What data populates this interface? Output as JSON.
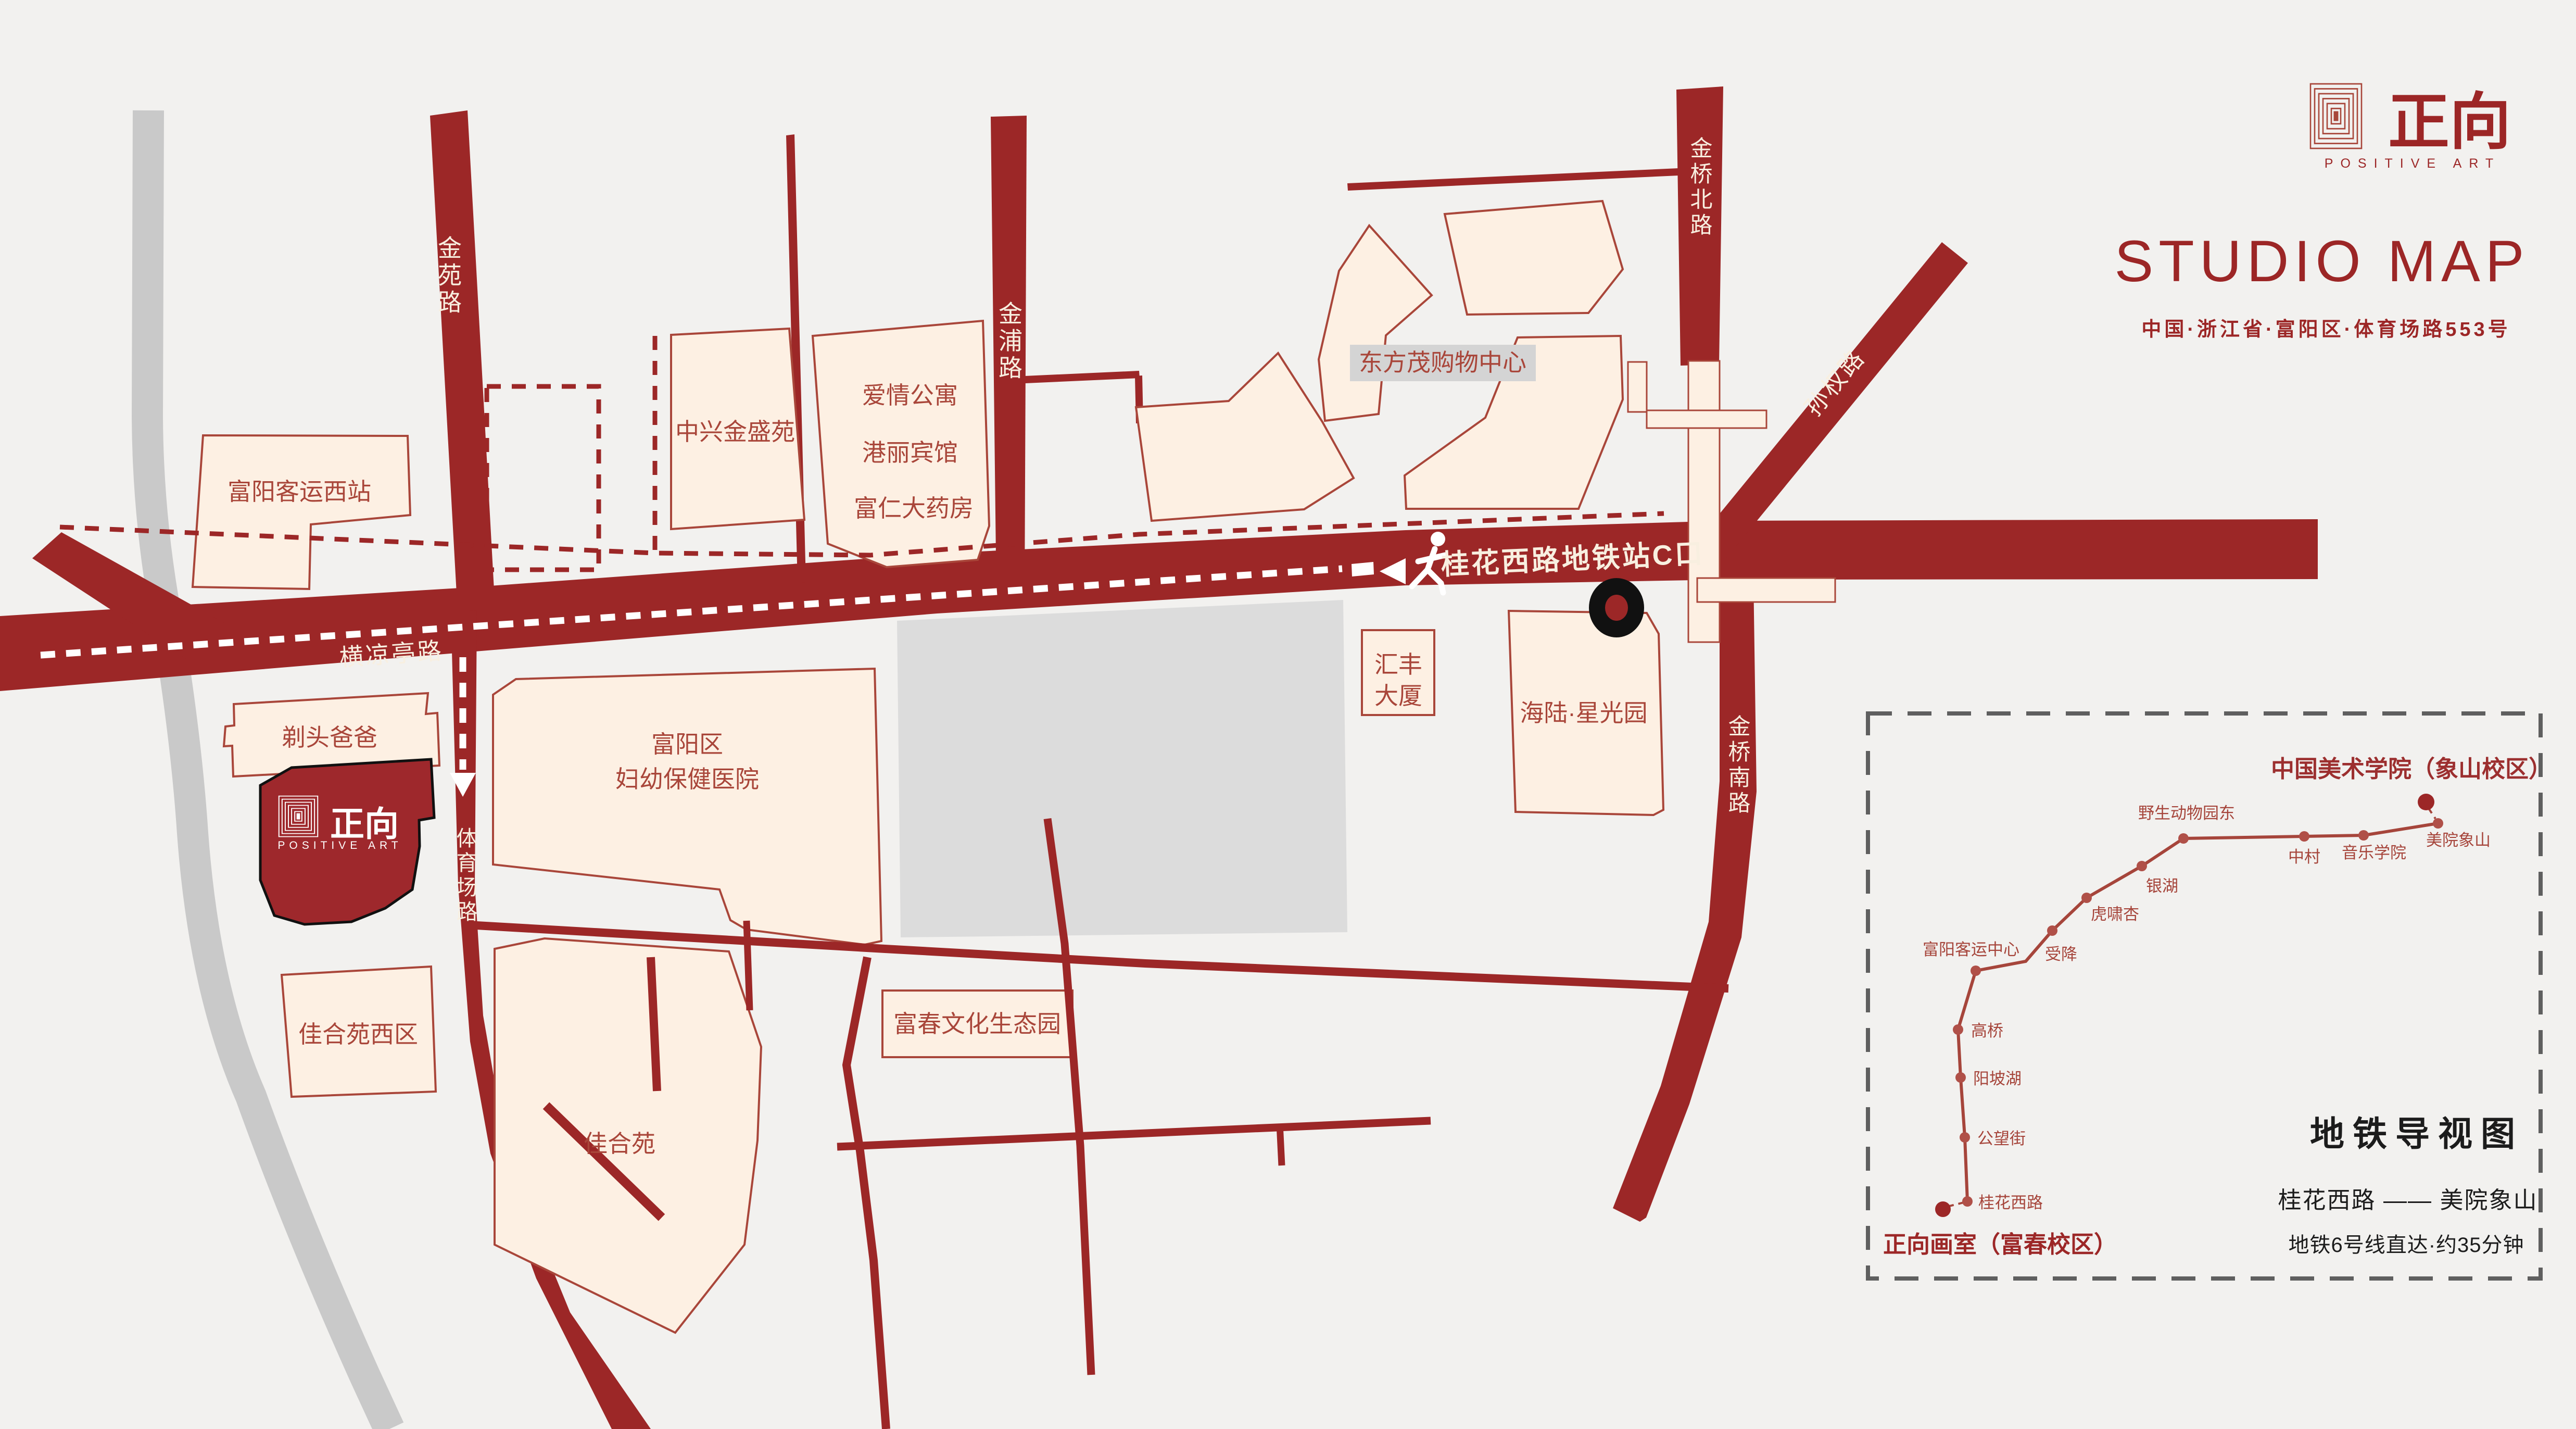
{
  "brand": {
    "logo_hanzi": "正向",
    "logo_latin": "POSITIVE ART",
    "title": "STUDIO MAP",
    "address": "中国·浙江省·富阳区·体育场路553号"
  },
  "map": {
    "roads": {
      "jinyuan": "金苑路",
      "jinpu": "金浦路",
      "jinqiao_north": "金桥北路",
      "sunquan": "孙权路",
      "jinqiao_south": "金桥南路",
      "hengliangting": "横凉亭路",
      "tiyuchang": "体育场路",
      "metro_exit_sign": "桂花西路地铁站C口"
    },
    "buildings": {
      "bus_station_west": "富阳客运西站",
      "zhongxing": "中兴金盛苑",
      "tenant_1": "爱情公寓",
      "tenant_2": "港丽宾馆",
      "tenant_3": "富仁大药房",
      "dongfangmao": "东方茂购物中心",
      "huifeng_line1": "汇丰",
      "huifeng_line2": "大厦",
      "hailu": "海陆·星光园",
      "hospital_line1": "富阳区",
      "hospital_line2": "妇幼保健医院",
      "titou": "剃头爸爸",
      "jiaheyuan_west": "佳合苑西区",
      "jiaheyuan": "佳合苑",
      "fuchun_park": "富春文化生态园"
    },
    "studio_marker": {
      "hanzi": "正向",
      "latin": "POSITIVE ART"
    }
  },
  "inset": {
    "title": "地铁导视图",
    "route": "桂花西路 —— 美院象山",
    "duration": "地铁6号线直达·约35分钟",
    "start_label": "正向画室（富春校区）",
    "end_label": "中国美术学院（象山校区）",
    "stations": [
      "桂花西路",
      "公望街",
      "阳坡湖",
      "高桥",
      "富阳客运中心",
      "受降",
      "虎啸杏",
      "银湖",
      "野生动物园东",
      "中村",
      "音乐学院",
      "美院象山"
    ]
  }
}
